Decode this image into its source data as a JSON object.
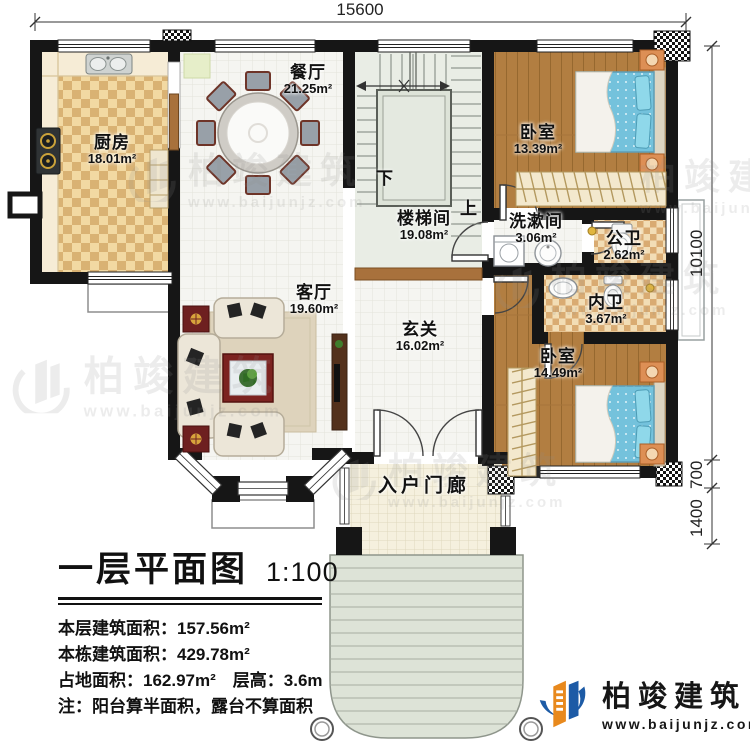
{
  "dimensions": {
    "top": "15600",
    "right": [
      "10100",
      "700",
      "1400"
    ]
  },
  "rooms": {
    "kitchen": {
      "name": "厨房",
      "area": "18.01m²"
    },
    "dining": {
      "name": "餐厅",
      "area": "21.25m²"
    },
    "stairwell": {
      "name": "楼梯间",
      "area": "19.08m²"
    },
    "bedroom_top": {
      "name": "卧室",
      "area": "13.39m²"
    },
    "washroom": {
      "name": "洗漱间",
      "area": "3.06m²"
    },
    "public_bath": {
      "name": "公卫",
      "area": "2.62m²"
    },
    "inner_bath": {
      "name": "内卫",
      "area": "3.67m²"
    },
    "bedroom_bottom": {
      "name": "卧室",
      "area": "14.49m²"
    },
    "foyer": {
      "name": "玄关",
      "area": "16.02m²"
    },
    "living": {
      "name": "客厅",
      "area": "19.60m²"
    },
    "porch": {
      "name": "入户门廊"
    }
  },
  "stairs": {
    "down": "下",
    "up": "上"
  },
  "title_block": {
    "title": "一层平面图",
    "scale": "1:100",
    "stats": [
      "本层建筑面积：157.56m²",
      "本栋建筑面积：429.78m²",
      "占地面积：162.97m²　层高：3.6m",
      "注：阳台算半面积，露台不算面积"
    ]
  },
  "brand": {
    "name": "柏竣建筑",
    "url": "www.baijunjz.com"
  },
  "watermark": {
    "name": "柏竣建筑",
    "url": "www.baijunjz.com"
  },
  "colors": {
    "wall": "#161616",
    "wood_floor": "#b27e41",
    "kitchen_check": "#d9b273",
    "bath_check": "#d9ab72",
    "mattress": "#74c2dc",
    "brand_blue": "#1d5ba6",
    "brand_orange": "#e8891d"
  }
}
